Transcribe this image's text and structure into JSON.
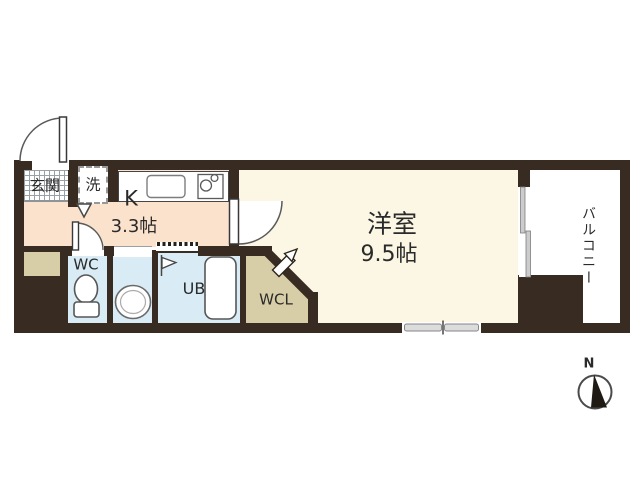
{
  "floorplan": {
    "type": "apartment-floor-plan",
    "rooms": {
      "genkan": {
        "label": "玄関"
      },
      "laundry": {
        "label": "洗"
      },
      "kitchen": {
        "label": "K",
        "size": "3.3帖"
      },
      "main_room": {
        "label": "洋室",
        "size": "9.5帖"
      },
      "toilet": {
        "label": "WC"
      },
      "unit_bath": {
        "label": "UB"
      },
      "walk_in_closet": {
        "label": "WCL"
      },
      "balcony": {
        "label": "バルコニー"
      }
    },
    "compass": {
      "north_label": "N"
    },
    "colors": {
      "wall": "#372b22",
      "kitchen_floor": "#fbe2cd",
      "main_room_floor": "#fbf7e4",
      "wet_area_floor": "#d9ebf4",
      "closet_floor": "#d7cda7",
      "background": "#ffffff"
    }
  }
}
